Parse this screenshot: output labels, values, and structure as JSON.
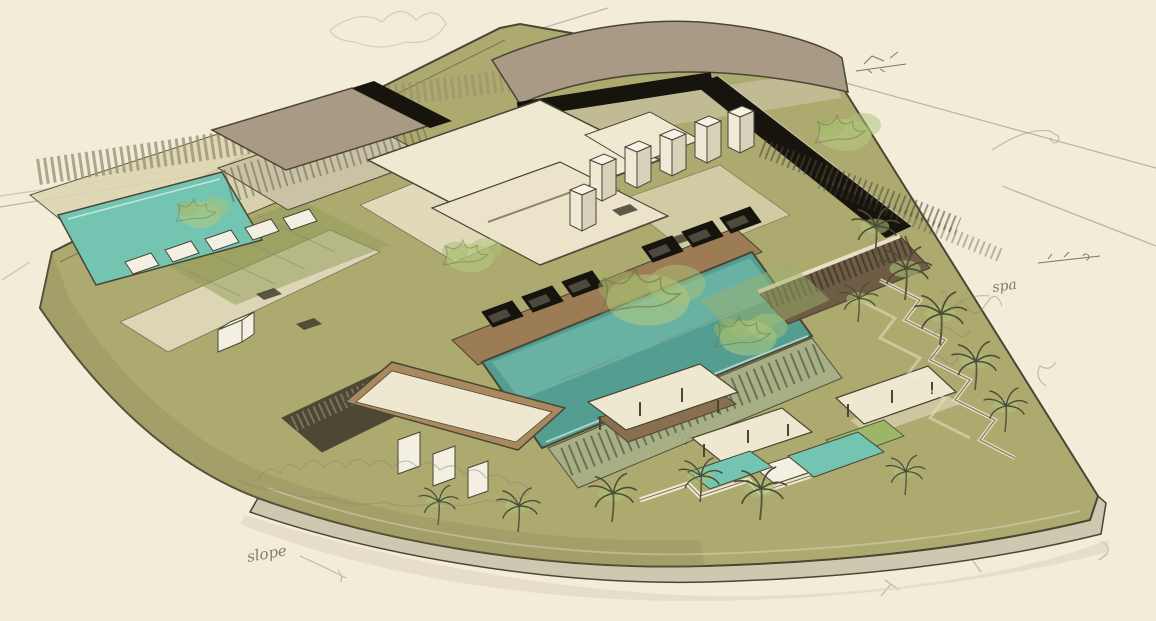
{
  "artwork": {
    "description": "Hand-drawn aerial perspective concept sketch of a resort masterplan on a fan-shaped raised site: long central lap pool with black cabanas, trellised courtyard pool at upper left, curved-roof arrival building at top, white villa towers, garden pavilions, plunge pools and palm planting along the right and lower edges",
    "annotations": {
      "slope_left": "slope",
      "spa_right": "spa"
    },
    "palette": {
      "paper": "#f2ecd9",
      "paper_shadow": "#ddd5bd",
      "site_green": "#adaa70",
      "site_shade": "#8f8c58",
      "base_wall": "#cfc8b0",
      "ink": "#4a4534",
      "pencil": "#8a8574",
      "pool_teal": "#539e91",
      "pool_teal_light": "#74c4b2",
      "deck_wood": "#9c7c54",
      "tan_frame": "#a98a5e",
      "roof_cream": "#efe8d1",
      "roof_taupe": "#a89a85",
      "roof_black": "#17140e",
      "building_white": "#f3efe2",
      "glass_dark": "#44402f",
      "louver_brown": "#6e5c44",
      "foliage_green": "#8fae58",
      "foliage_light": "#b7cb80",
      "handwriting": "#6e6a58"
    }
  }
}
